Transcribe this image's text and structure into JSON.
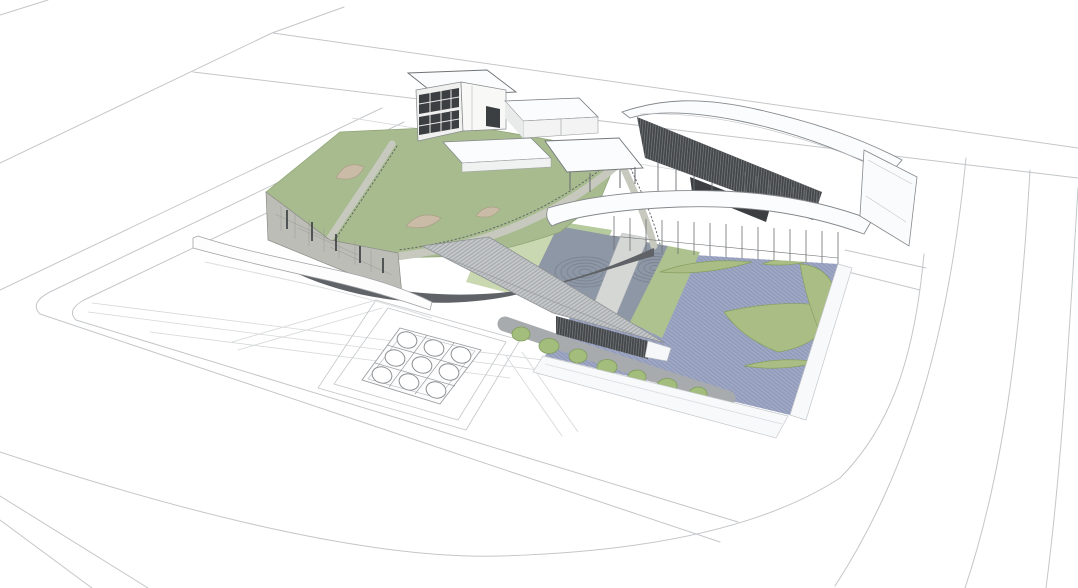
{
  "scene": {
    "type": "architectural-3d-massing-rendering",
    "view": "aerial-axonometric",
    "skylight_grid": {
      "rows": 3,
      "cols": 3,
      "circle_count": 9
    },
    "tree_circle_count": 7,
    "ripple_pond_groups": 2,
    "deck_leaf_count": 5,
    "roof_ramp_count": 3
  },
  "palette": {
    "background": "#ffffff",
    "line": "#c3c6c9",
    "faintLine": "#d4d7d9",
    "roofGreen": "#a7bb8f",
    "roofGreenEdge": "#8fa476",
    "lawnLight": "#c9d8b1",
    "lawnMid": "#b6cb9d",
    "stripGreen": "#aec290",
    "garden": "#8e97a5",
    "ripple": "#7b8493",
    "walkway": "#d5d7d4",
    "deck": "#9ea7c4",
    "deckStripe": "#8c95b5",
    "leaf": "#a9bd84",
    "leafEdge": "#86a05f",
    "circleGreen": "#a3bd7d",
    "circleEdge": "#7f9c5b",
    "pathGray": "#a8abad",
    "rampGray": "#c7c9bf",
    "railDark": "#5b5e61",
    "stone": "#bdbdb8",
    "stoneEdge": "#8b8b86",
    "slitDark": "#45484a",
    "swooshDark": "#5f6266",
    "bridgeGray": "#c4c7c9",
    "bridgeHatch": "#96999c",
    "louverDark": "#44474a",
    "louverLine": "#84878a",
    "white": "#fbfcfd",
    "fascia": "#f8f9fb",
    "tan": "#c9bba6",
    "tanEdge": "#a99a84",
    "glass": "#3c3f42",
    "mullion": "#6e7174",
    "edgeDark": "#85888b"
  }
}
